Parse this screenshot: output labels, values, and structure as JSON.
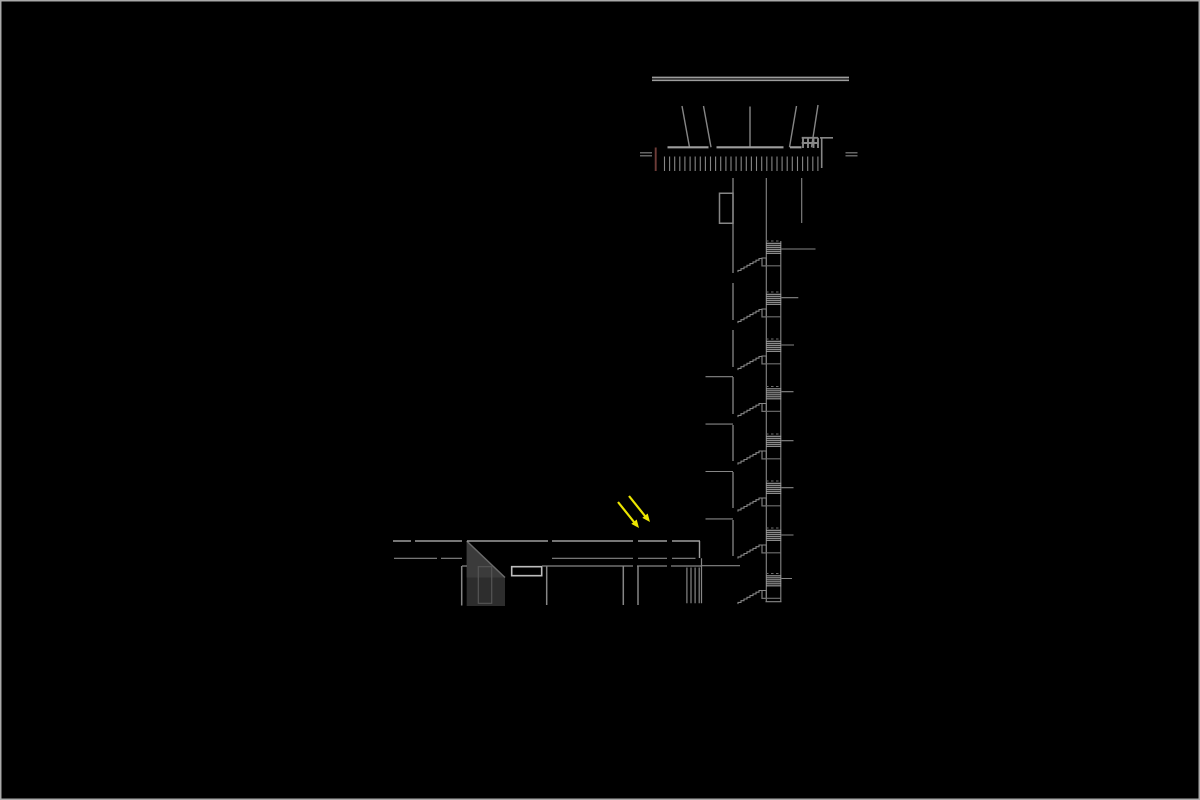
{
  "drawing": {
    "kind": "architectural-section",
    "subject": "control-tower-with-low-annex-building",
    "floors_in_tower": 8,
    "stair_flights": 8,
    "annotation_arrows": 2
  },
  "colors": {
    "background": "#000000",
    "frame_border": "#a9a9a9",
    "line": "#868686",
    "line_bright": "#9d9d9d",
    "line_dim": "#6f6f6f",
    "red_marker": "#6e3c38",
    "arrow_yellow": "#ece500",
    "fill_dark": "#2d2d2d",
    "fill_mid": "#3b3b3b",
    "detail_edge": "#6a6a6a",
    "inner_door_line": "#555555",
    "white_detail": "#bdbdbd"
  }
}
